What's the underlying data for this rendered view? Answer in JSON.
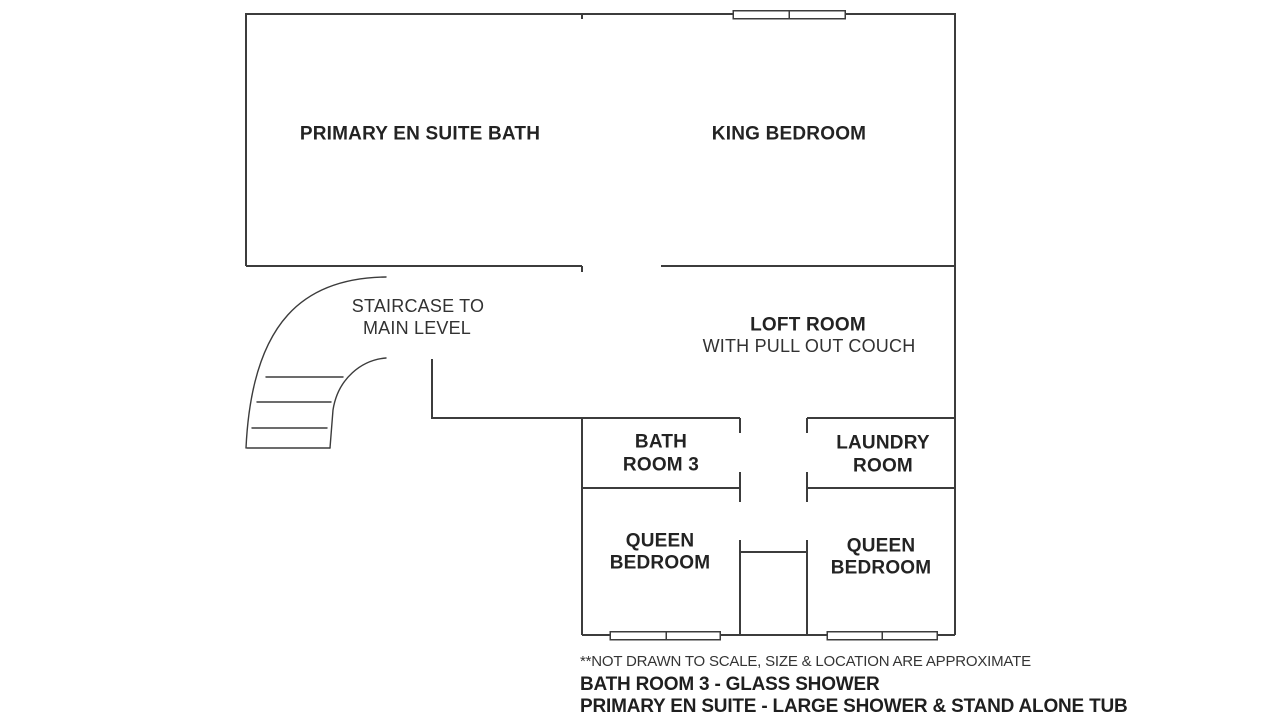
{
  "floor_plan": {
    "rooms": {
      "primary_bath": {
        "label": "PRIMARY EN SUITE BATH"
      },
      "king_bedroom": {
        "label": "KING BEDROOM"
      },
      "staircase": {
        "line1": "STAIRCASE TO",
        "line2": "MAIN LEVEL"
      },
      "loft": {
        "line1": "LOFT ROOM",
        "line2": "WITH PULL OUT COUCH"
      },
      "bath_room_3": {
        "line1": "BATH",
        "line2": "ROOM 3"
      },
      "laundry": {
        "line1": "LAUNDRY",
        "line2": "ROOM"
      },
      "queen_left": {
        "line1": "QUEEN",
        "line2": "BEDROOM"
      },
      "queen_right": {
        "line1": "QUEEN",
        "line2": "BEDROOM"
      }
    },
    "footer": {
      "disclaimer": "**NOT DRAWN TO SCALE, SIZE & LOCATION ARE APPROXIMATE",
      "note_bath": "BATH ROOM 3 - GLASS SHOWER",
      "note_primary": "PRIMARY EN SUITE - LARGE SHOWER & STAND ALONE TUB"
    },
    "colors": {
      "wall": "#3c3c3c",
      "text": "#232323",
      "background": "#ffffff"
    }
  }
}
